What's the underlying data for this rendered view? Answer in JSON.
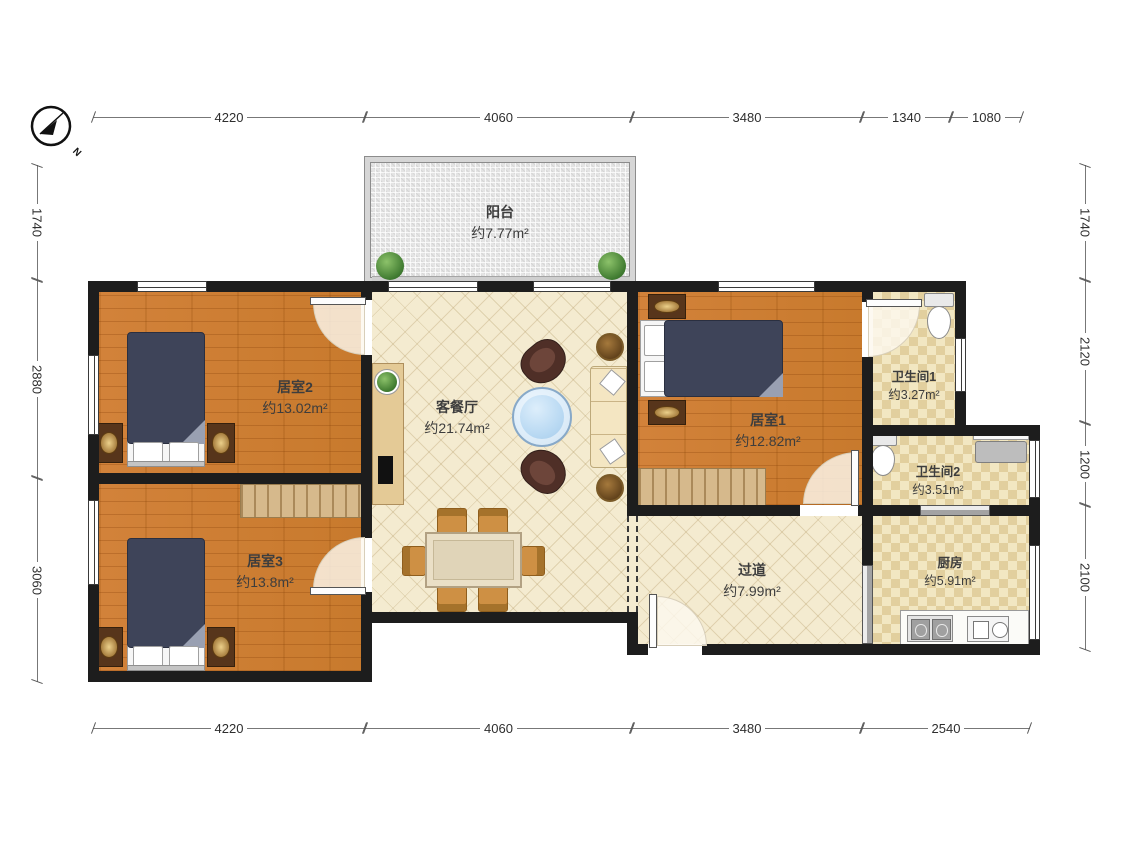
{
  "compass": {
    "label": "N"
  },
  "dimensions": {
    "top": [
      "4220",
      "4060",
      "3480",
      "1340",
      "1080"
    ],
    "bottom": [
      "4220",
      "4060",
      "3480",
      "2540"
    ],
    "left": [
      "1740",
      "2880",
      "3060"
    ],
    "right": [
      "1740",
      "2120",
      "1200",
      "2100"
    ]
  },
  "rooms": {
    "balcony": {
      "name": "阳台",
      "area": "约7.77m²"
    },
    "bedroom2": {
      "name": "居室2",
      "area": "约13.02m²"
    },
    "bedroom3": {
      "name": "居室3",
      "area": "约13.8m²"
    },
    "living": {
      "name": "客餐厅",
      "area": "约21.74m²"
    },
    "bedroom1": {
      "name": "居室1",
      "area": "约12.82m²"
    },
    "bathroom1": {
      "name": "卫生间1",
      "area": "约3.27m²"
    },
    "bathroom2": {
      "name": "卫生间2",
      "area": "约3.51m²"
    },
    "hallway": {
      "name": "过道",
      "area": "约7.99m²"
    },
    "kitchen": {
      "name": "厨房",
      "area": "约5.91m²"
    }
  },
  "colors": {
    "wall": "#1d1d1d",
    "wood_floor": "#cd7e33",
    "lattice_floor": "#f4ebd0",
    "checker_floor": "#f2e7c2",
    "balcony_floor": "#e4e4e4",
    "bed_duvet": "#3e4459",
    "furniture_tan": "#d6b98c",
    "coffee_table": "#b7d8f2"
  }
}
